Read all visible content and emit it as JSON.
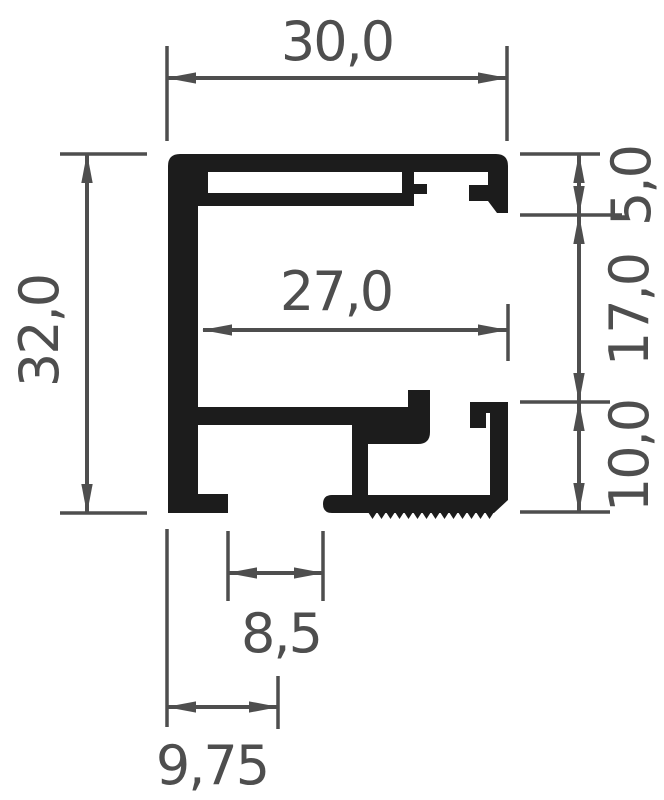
{
  "drawing": {
    "type": "profile-cross-section",
    "dimensions": {
      "overall_width": "30,0",
      "overall_height": "32,0",
      "inner_width": "27,0",
      "top_channel_height": "5,0",
      "middle_height": "17,0",
      "bottom_channel_height": "10,0",
      "bottom_slot_width": "8,5",
      "bottom_slot_offset": "9,75"
    },
    "colors": {
      "profile": "#1c1c1c",
      "dimension": "#4e4e4e",
      "background": "#ffffff"
    }
  }
}
